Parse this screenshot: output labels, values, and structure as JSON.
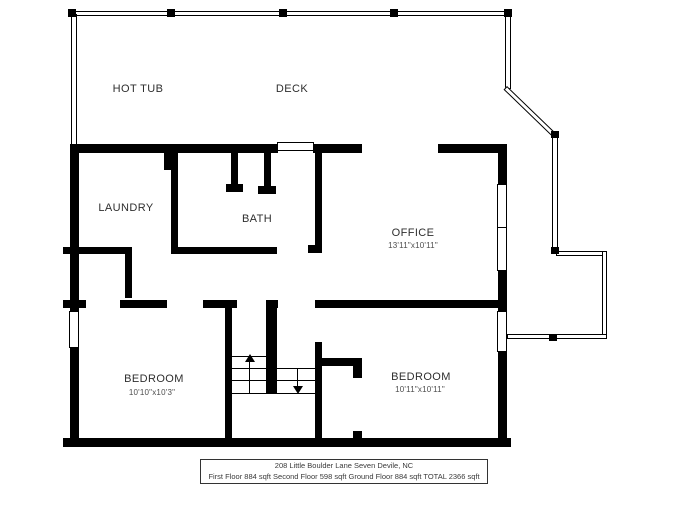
{
  "plan": {
    "outdoor": {
      "hot_tub_label": "HOT TUB",
      "deck_label": "DECK"
    },
    "rooms": {
      "laundry": {
        "label": "LAUNDRY"
      },
      "bath": {
        "label": "BATH"
      },
      "office": {
        "label": "OFFICE",
        "dimensions": "13'11\"x10'11\""
      },
      "bedroom_left": {
        "label": "BEDROOM",
        "dimensions": "10'10\"x10'3\""
      },
      "bedroom_right": {
        "label": "BEDROOM",
        "dimensions": "10'11\"x10'11\""
      }
    }
  },
  "footer": {
    "address": "208 Little Boulder Lane Seven Devile, NC",
    "areas": "First Floor 884 sqft Second Floor 598 sqft Ground Floor 884 sqft TOTAL 2366 sqft"
  },
  "colors": {
    "wall": "#000000",
    "background": "#ffffff",
    "label_text": "#2e2e2e",
    "dim_text": "#4d4d4d"
  }
}
